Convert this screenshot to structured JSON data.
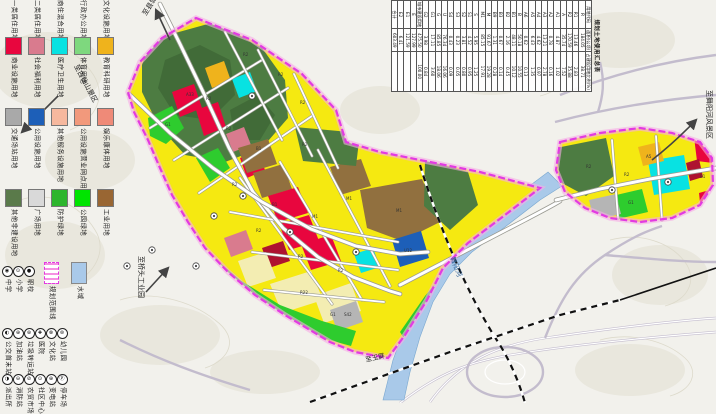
{
  "palette": {
    "residential_yellow": "#f5e911",
    "mixed_pale_yellow": "#f3edb2",
    "commercial_red": "#e8063e",
    "education_orange": "#efb31c",
    "medical_cyan": "#08e2e2",
    "utility_blue": "#1d5fb8",
    "industry_brown": "#91703f",
    "hill_green": "#4d7c42",
    "park_green": "#2ecc2e",
    "transport_gray": "#b5b5b5",
    "welfare_rose": "#d97b8e",
    "water_blue": "#a9c9e9",
    "boundary_magenta": "#e23ae2"
  },
  "legend": {
    "swatch_rows": [
      {
        "top": -20,
        "items": [
          {
            "color": "#fdfdc8",
            "label": "一类居住用地"
          },
          {
            "color": "#f5e911",
            "label": "二类居住用地"
          },
          {
            "color": "#f3edb2",
            "label": "商住混合用地"
          },
          {
            "color": "#e080c0",
            "label": "行政办公用地"
          },
          {
            "color": "#cc66cc",
            "label": "文化设施用地"
          }
        ]
      },
      {
        "top": 37,
        "items": [
          {
            "color": "#e8063e",
            "label": "商业设施用地"
          },
          {
            "color": "#d97b8e",
            "label": "社会福利用地"
          },
          {
            "color": "#08e2e2",
            "label": "医疗卫生用地"
          },
          {
            "color": "#7ed87e",
            "label": "体育用地"
          },
          {
            "color": "#efb31c",
            "label": "教育科研用地"
          }
        ]
      },
      {
        "top": 108,
        "items": [
          {
            "color": "#a9a9a9",
            "label": "交通场站用地"
          },
          {
            "color": "#1d5fb8",
            "label": "公用设施用地"
          },
          {
            "color": "#f6b89e",
            "label": "其他服务设施用地"
          },
          {
            "color": "#f2997c",
            "label": "公用设施营业网点用地"
          },
          {
            "color": "#ef8a78",
            "label": "娱乐康体用地"
          }
        ]
      },
      {
        "top": 189,
        "items": [
          {
            "color": "#5a7a4a",
            "label": "其他非建设用地"
          },
          {
            "color": "#d9d9d9",
            "label": "广场用地"
          },
          {
            "color": "#2db52d",
            "label": "防护绿地"
          },
          {
            "color": "#00e400",
            "label": "公园绿地"
          },
          {
            "color": "#996633",
            "label": "工业用地"
          }
        ]
      }
    ],
    "boundary_item": {
      "label": "规划范围线",
      "left": 40,
      "top": 262
    },
    "water_item": {
      "label": "水域",
      "left": 53,
      "top": 262,
      "color": "#a9c9e9"
    },
    "symbol_rows": [
      {
        "top": 266,
        "x": [
          1,
          12,
          23
        ],
        "items": [
          {
            "glyph": "◉",
            "label": "中学"
          },
          {
            "glyph": "⊙",
            "label": "小学"
          },
          {
            "glyph": "●",
            "label": "职校"
          }
        ]
      },
      {
        "top": 328,
        "x": [
          1,
          12,
          23,
          34,
          45,
          56
        ],
        "items": [
          {
            "glyph": "◐",
            "label": "公交首末站"
          },
          {
            "glyph": "⊕",
            "label": "加油站"
          },
          {
            "glyph": "⊛",
            "label": "垃圾转运站"
          },
          {
            "glyph": "✚",
            "label": "医院"
          },
          {
            "glyph": "⊗",
            "label": "文化站"
          },
          {
            "glyph": "⊜",
            "label": "幼儿园"
          }
        ]
      },
      {
        "top": 374,
        "x": [
          1,
          12,
          23,
          34,
          45,
          56
        ],
        "items": [
          {
            "glyph": "◑",
            "label": "派出所"
          },
          {
            "glyph": "⊖",
            "label": "消防站"
          },
          {
            "glyph": "⊘",
            "label": "农贸市场"
          },
          {
            "glyph": "⊙",
            "label": "社区中心"
          },
          {
            "glyph": "⊕",
            "label": "变电站"
          },
          {
            "glyph": "Ⓟ",
            "label": "停车场"
          }
        ]
      }
    ]
  },
  "table": {
    "title": "规划土地使用汇总表",
    "columns": [
      "用地代码",
      "面积(公顷)",
      "占建设用地比例(%)"
    ],
    "rows": [
      [
        "R",
        "184.05",
        "38.71"
      ],
      [
        "R1",
        "13.46",
        "2.83"
      ],
      [
        "R2",
        "170.59",
        "35.88"
      ],
      [
        "A",
        "35.74",
        "7.52"
      ],
      [
        "A1",
        "4.87",
        "1.02"
      ],
      [
        "A2",
        "0.78",
        "0.16"
      ],
      [
        "A3",
        "13.21",
        "2.78"
      ],
      [
        "A4",
        "4.62",
        "0.97"
      ],
      [
        "A5",
        "6.43",
        "1.35"
      ],
      [
        "A6",
        "0.62",
        "0.13"
      ],
      [
        "B",
        "50.18",
        "10.55"
      ],
      [
        "B1",
        "48.11",
        "10.12"
      ],
      [
        "B2",
        "2.16",
        "0.45"
      ],
      [
        "B3",
        "0.67",
        "0.14"
      ],
      [
        "B9",
        "1.31",
        "0.28"
      ],
      [
        "M",
        "91.67",
        "19.28"
      ],
      [
        "M1",
        "85.15",
        "17.91"
      ],
      [
        "S",
        "5.95",
        "1.25"
      ],
      [
        "S1",
        "4.52",
        "0.95"
      ],
      [
        "S2",
        "3.81",
        "0.80"
      ],
      [
        "S3",
        "0.23",
        "0.05"
      ],
      [
        "S4",
        "0.43",
        "0.09"
      ],
      [
        "U",
        "76.34",
        "16.06"
      ],
      [
        "G",
        "85.85",
        "18.06"
      ],
      [
        "G1",
        "17.11",
        "3.60"
      ],
      [
        "G2",
        "3.98",
        "0.84"
      ],
      [
        "城市建设用地",
        "475.50",
        "100.00"
      ],
      [
        "E",
        "127.99",
        ""
      ],
      [
        "E1",
        "121.59",
        ""
      ],
      [
        "E2",
        "6.41",
        ""
      ],
      [
        "合计",
        "603.49",
        ""
      ]
    ]
  },
  "map": {
    "labels": [
      {
        "text": "至县城",
        "x": 146,
        "y": 16,
        "rot": -58,
        "fs": 7,
        "cls": "maplabel"
      },
      {
        "text": "至古仙山景区",
        "x": 74,
        "y": 66,
        "rot": 62,
        "fs": 7,
        "cls": "maplabel"
      },
      {
        "text": "至桥头工业园",
        "x": 139,
        "y": 256,
        "rot": 90,
        "fs": 7,
        "cls": "maplabel"
      },
      {
        "text": "至舞阳河风景区",
        "x": 707,
        "y": 90,
        "rot": 90,
        "fs": 7,
        "cls": "maplabel"
      },
      {
        "text": "舞阳河",
        "x": 450,
        "y": 258,
        "rot": 68,
        "fs": 7,
        "cls": "riverlabel"
      },
      {
        "text": "至玉屏",
        "x": 366,
        "y": 362,
        "rot": -13,
        "fs": 6.5,
        "cls": "maplabel"
      }
    ],
    "block_codes": [
      {
        "t": "R2",
        "x": 243,
        "y": 56
      },
      {
        "t": "R2",
        "x": 278,
        "y": 76
      },
      {
        "t": "R2",
        "x": 206,
        "y": 100
      },
      {
        "t": "R2",
        "x": 300,
        "y": 104
      },
      {
        "t": "G1",
        "x": 165,
        "y": 126
      },
      {
        "t": "A33",
        "x": 186,
        "y": 96
      },
      {
        "t": "R2",
        "x": 226,
        "y": 130
      },
      {
        "t": "B1",
        "x": 256,
        "y": 150
      },
      {
        "t": "R2",
        "x": 302,
        "y": 146
      },
      {
        "t": "R2",
        "x": 232,
        "y": 186
      },
      {
        "t": "B1",
        "x": 272,
        "y": 206
      },
      {
        "t": "M1",
        "x": 312,
        "y": 218
      },
      {
        "t": "M1",
        "x": 346,
        "y": 200
      },
      {
        "t": "M1",
        "x": 396,
        "y": 212
      },
      {
        "t": "R2",
        "x": 256,
        "y": 232
      },
      {
        "t": "R2",
        "x": 298,
        "y": 258
      },
      {
        "t": "R2",
        "x": 338,
        "y": 272
      },
      {
        "t": "R22",
        "x": 300,
        "y": 294
      },
      {
        "t": "G1",
        "x": 330,
        "y": 316
      },
      {
        "t": "U12",
        "x": 404,
        "y": 252
      },
      {
        "t": "S42",
        "x": 344,
        "y": 316
      },
      {
        "t": "R2",
        "x": 586,
        "y": 168
      },
      {
        "t": "R2",
        "x": 624,
        "y": 176
      },
      {
        "t": "A5",
        "x": 646,
        "y": 158
      },
      {
        "t": "B1",
        "x": 700,
        "y": 178
      },
      {
        "t": "G1",
        "x": 628,
        "y": 204
      }
    ],
    "icons": [
      {
        "x": 152,
        "y": 250
      },
      {
        "x": 127,
        "y": 266
      },
      {
        "x": 196,
        "y": 266
      },
      {
        "x": 214,
        "y": 216
      },
      {
        "x": 243,
        "y": 196
      },
      {
        "x": 290,
        "y": 232
      },
      {
        "x": 356,
        "y": 252
      },
      {
        "x": 612,
        "y": 190
      },
      {
        "x": 668,
        "y": 182
      },
      {
        "x": 252,
        "y": 96
      }
    ]
  }
}
